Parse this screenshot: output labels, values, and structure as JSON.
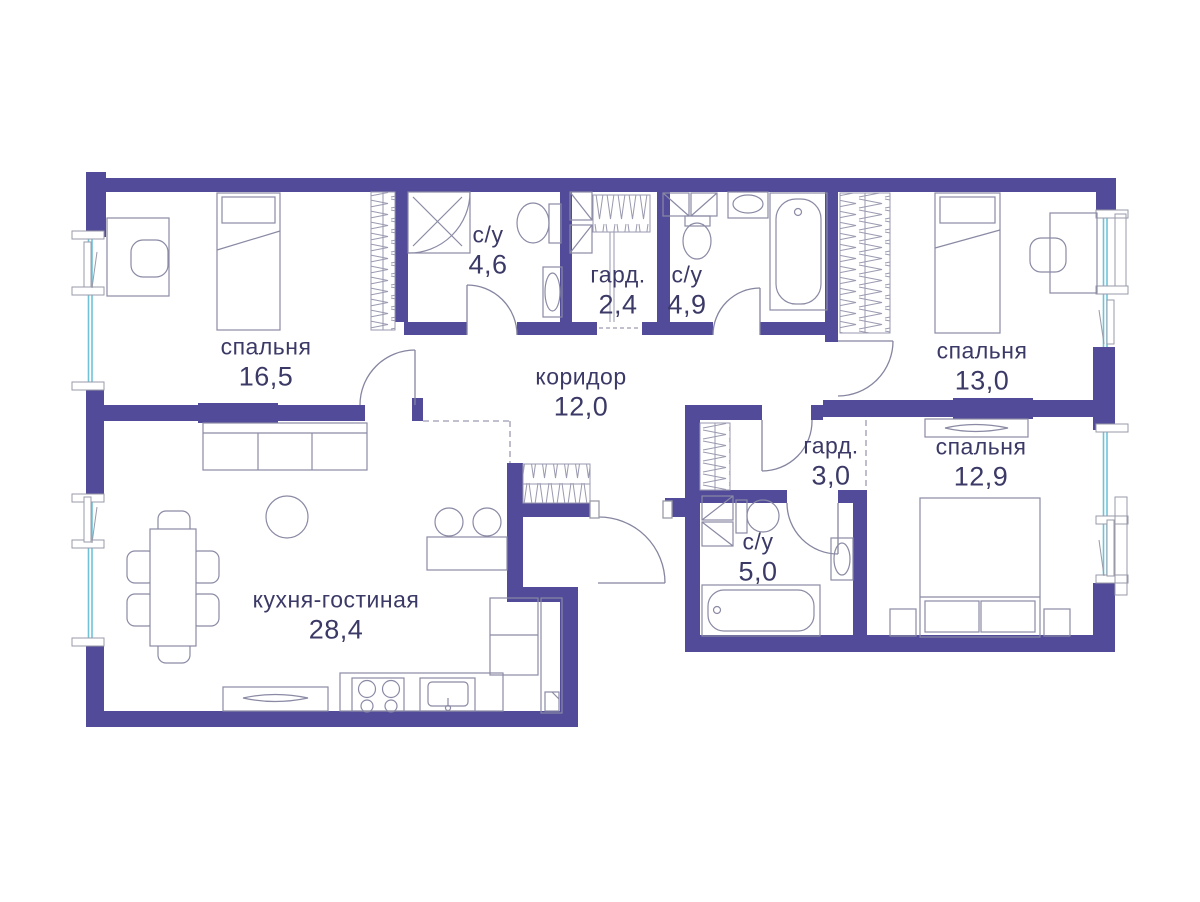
{
  "plan": {
    "type": "apartment-floor-plan",
    "rooms": [
      {
        "id": "bedroom-1",
        "label": "спальня",
        "area": "16,5"
      },
      {
        "id": "bathroom-1",
        "label": "с/у",
        "area": "4,6"
      },
      {
        "id": "wardrobe-1",
        "label": "гард.",
        "area": "2,4"
      },
      {
        "id": "bathroom-2",
        "label": "с/у",
        "area": "4,9"
      },
      {
        "id": "bedroom-2",
        "label": "спальня",
        "area": "13,0"
      },
      {
        "id": "corridor",
        "label": "коридор",
        "area": "12,0"
      },
      {
        "id": "wardrobe-2",
        "label": "гард.",
        "area": "3,0"
      },
      {
        "id": "bathroom-3",
        "label": "с/у",
        "area": "5,0"
      },
      {
        "id": "bedroom-3",
        "label": "спальня",
        "area": "12,9"
      },
      {
        "id": "kitchen-living",
        "label": "кухня-гостиная",
        "area": "28,4"
      }
    ],
    "colors": {
      "wall": "#514b99",
      "furniture_line": "#8a8aa5",
      "label_text": "#3b3966",
      "window_glass": "#6fc3d8",
      "dashed_line": "#9a9ab2"
    }
  }
}
